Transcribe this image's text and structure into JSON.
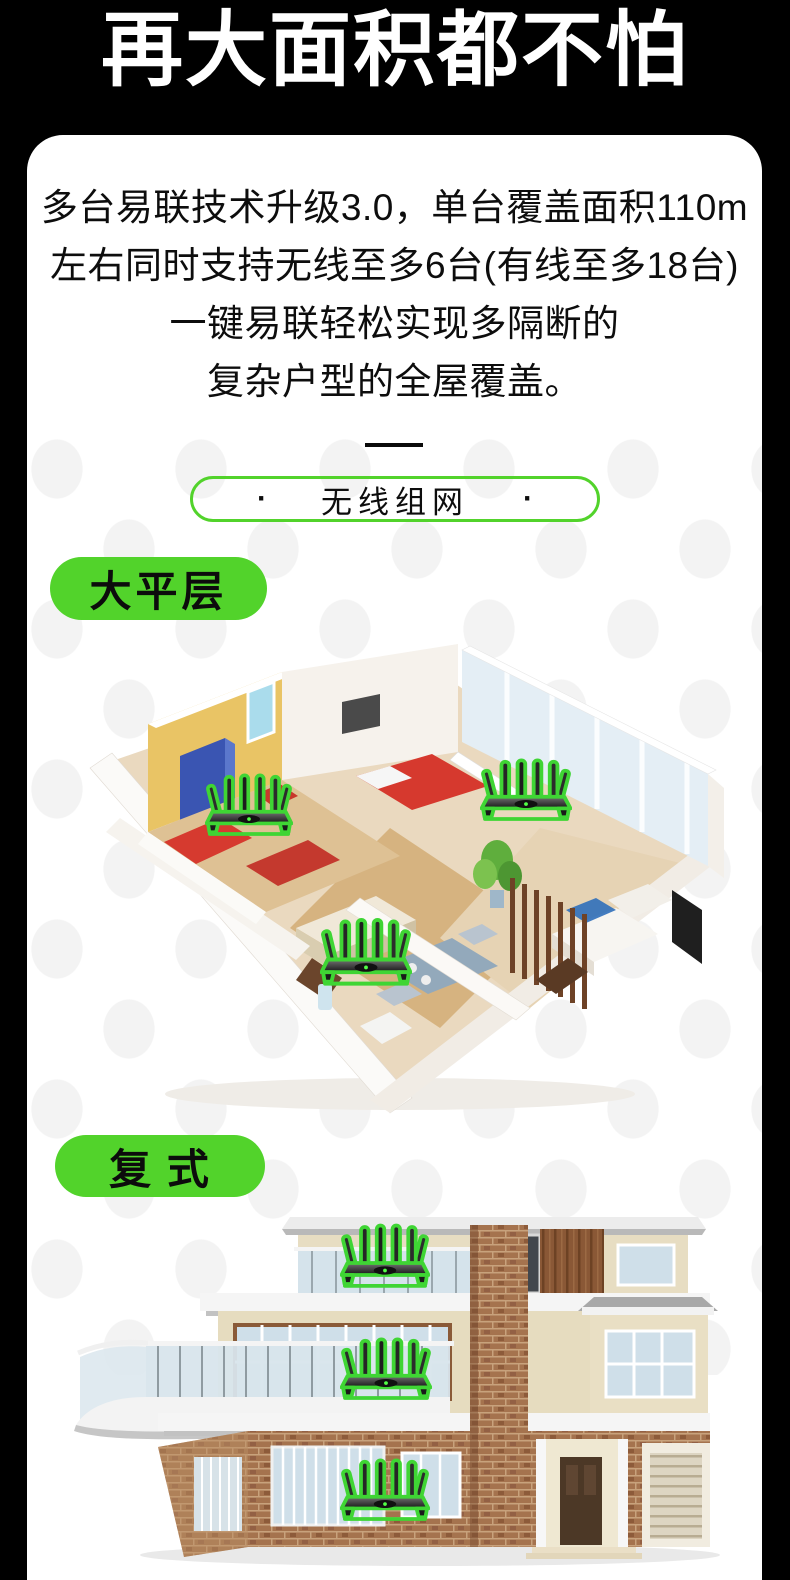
{
  "theme": {
    "page_bg": "#000000",
    "card_bg": "#ffffff",
    "accent_green": "#52d32b",
    "router_green": "#3fd534",
    "text_color": "#0d0d0d",
    "dot_color": "#f3f3f3"
  },
  "header": {
    "title": "再大面积都不怕"
  },
  "intro": {
    "lines": [
      "多台易联技术升级3.0，单台覆盖面积110m",
      "左右同时支持无线至多6台(有线至多18台)",
      "一键易联轻松实现多隔断的",
      "复杂户型的全屋覆盖。"
    ]
  },
  "nav_pill": {
    "dot": "·",
    "label": "无线组网"
  },
  "sections": [
    {
      "label": "大平层",
      "figure_alt": "大平层户型三维图，室内放置三台路由器"
    },
    {
      "label": "复 式",
      "figure_alt": "三层复式别墅三维图，每层放置一台路由器"
    }
  ]
}
